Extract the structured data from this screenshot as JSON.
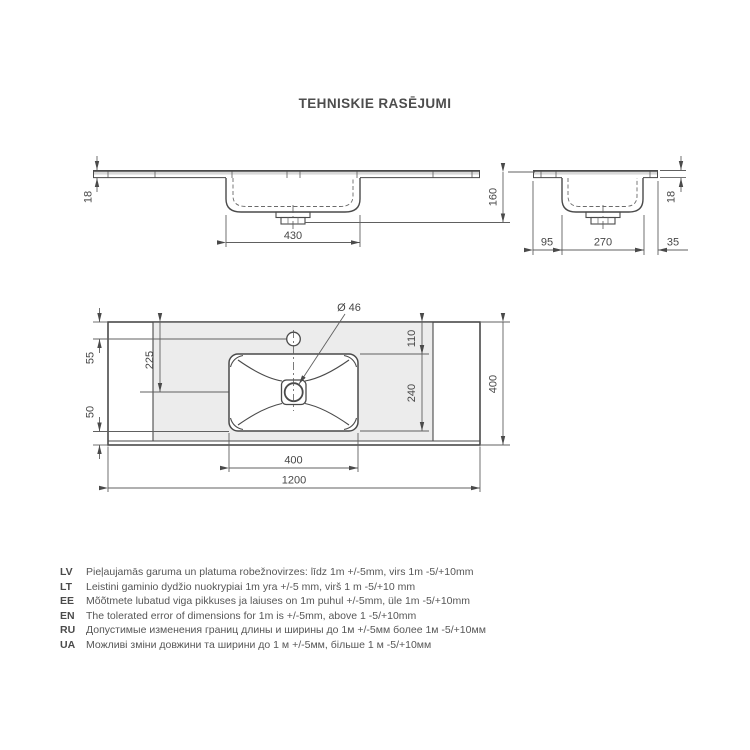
{
  "title": "TEHNISKIE RASĒJUMI",
  "views": {
    "front": {
      "thickness": "18",
      "basin_width": "430"
    },
    "side": {
      "height": "160",
      "thickness": "18",
      "back": "95",
      "basin_depth": "270",
      "front": "35"
    },
    "top": {
      "faucet_offset": "55",
      "drain_offset": "225",
      "front_margin": "50",
      "basin_top_offset": "110",
      "basin_depth": "240",
      "depth": "400",
      "basin_width": "400",
      "width": "1200",
      "drain_diameter": "Ø 46"
    }
  },
  "notes": [
    {
      "lang": "LV",
      "text": "Pieļaujamās garuma un platuma robežnovirzes: līdz 1m +/-5mm, virs 1m -5/+10mm"
    },
    {
      "lang": "LT",
      "text": "Leistini gaminio dydžio nuokrypiai 1m yra +/-5 mm, virš 1 m -5/+10 mm"
    },
    {
      "lang": "EE",
      "text": "Mõõtmete lubatud viga pikkuses ja laiuses on 1m puhul +/-5mm, üle 1m -5/+10mm"
    },
    {
      "lang": "EN",
      "text": "The tolerated error of dimensions for 1m is +/-5mm, above 1 -5/+10mm"
    },
    {
      "lang": "RU",
      "text": "Допустимые изменения границ длины и ширины до 1м +/-5мм более 1м -5/+10мм"
    },
    {
      "lang": "UA",
      "text": "Можливі зміни довжини та ширини до 1 м +/-5мм, більше 1 м -5/+10мм"
    }
  ],
  "colors": {
    "line": "#4a4a4a",
    "deck_shade": "#ececec",
    "slab_band": "#d8d8d8",
    "basin_fill": "#f4f4f4"
  }
}
